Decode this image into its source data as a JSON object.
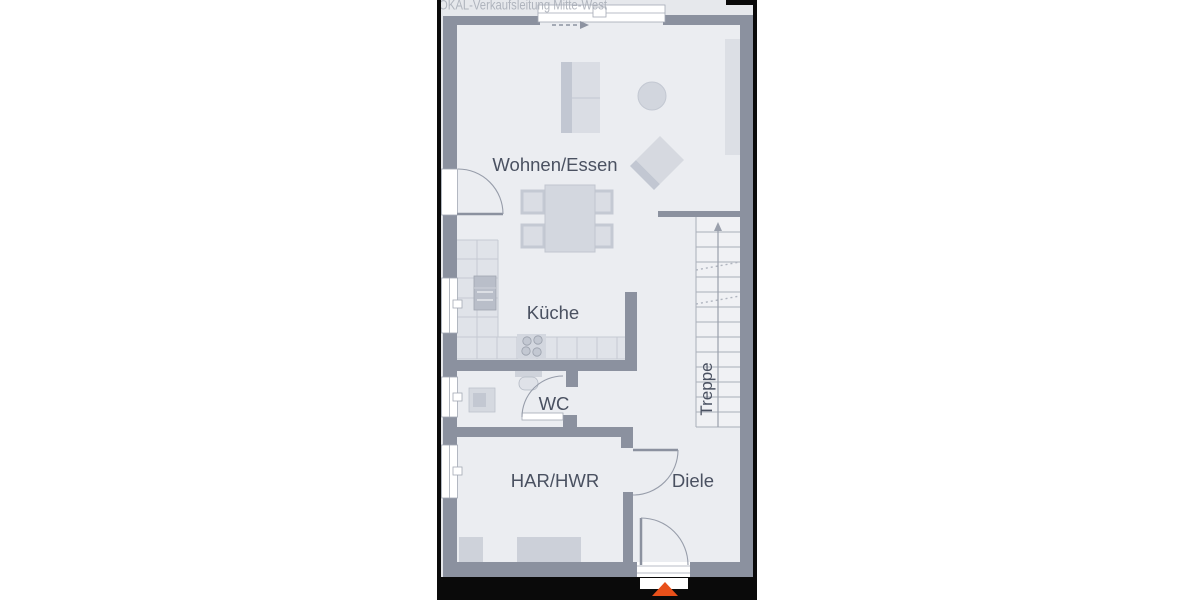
{
  "watermark": "OKAL-Verkaufsleitung Mitte-West",
  "floorplan": {
    "rooms": {
      "living_dining": "Wohnen/Essen",
      "kitchen": "Küche",
      "wc": "WC",
      "utility": "HAR/HWR",
      "hallway": "Diele",
      "stairs": "Treppe"
    },
    "colors": {
      "wall": "#8b919f",
      "floor": "#ebedf1",
      "photo_background": "#e6e8ec",
      "furniture": "#d5d8e0",
      "appliance_dark": "#b9bec9",
      "label_text": "#4a5161",
      "watermark_text": "#a6abb5",
      "entrance_arrow": "#e8501a",
      "photo_border": "#0a0a0a"
    },
    "icons": {
      "entrance_arrow": "triangle-up",
      "stair_direction_arrow": "arrow-up",
      "section_direction_arrow": "dashed-arrow-right"
    }
  }
}
